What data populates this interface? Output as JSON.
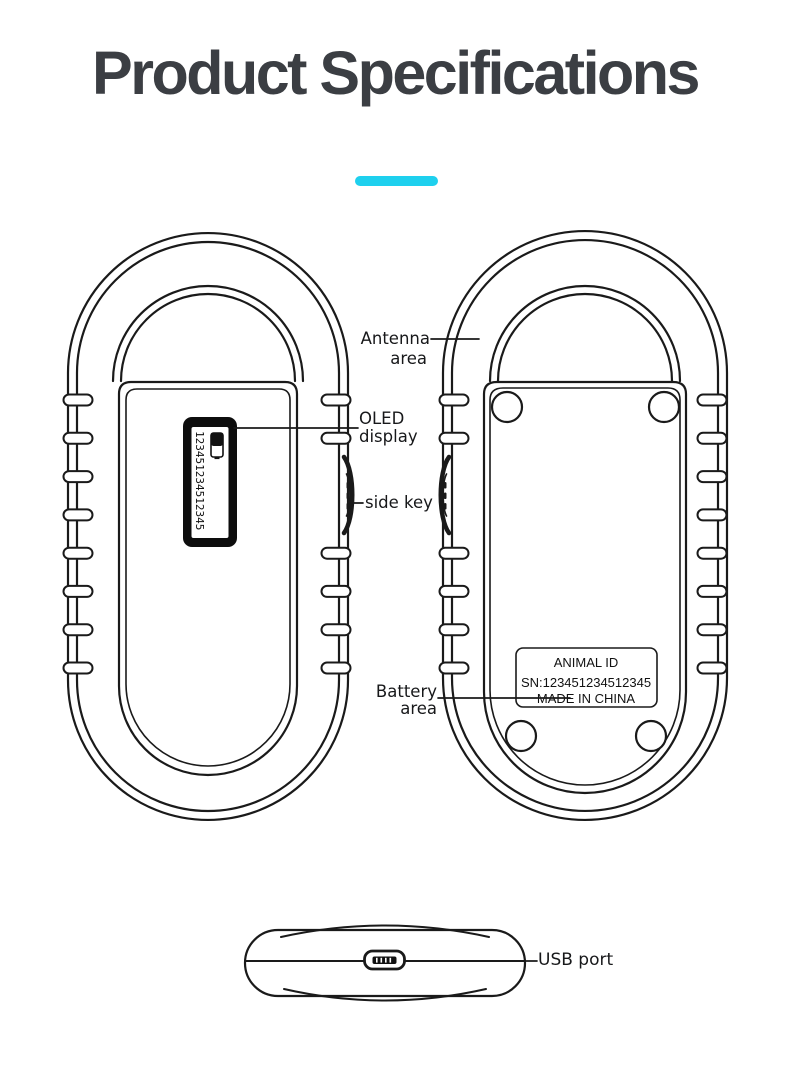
{
  "header": {
    "title": "Product Specifications",
    "accent_color": "#1ed0ee",
    "title_color": "#3b3e43"
  },
  "callouts": {
    "antenna": {
      "line1": "Antenna",
      "line2": "area"
    },
    "oled": {
      "line1": "OLED",
      "line2": "display"
    },
    "side_key": {
      "label": "side key"
    },
    "battery": {
      "line1": "Battery",
      "line2": "area"
    },
    "usb": {
      "label": "USB port"
    }
  },
  "device_front": {
    "oled_text": "123451234512345"
  },
  "device_back": {
    "plate": {
      "line1": "ANIMAL ID",
      "line2": "SN:123451234512345",
      "line3": "MADE IN CHINA"
    }
  },
  "line_color": "#1a1a1a"
}
